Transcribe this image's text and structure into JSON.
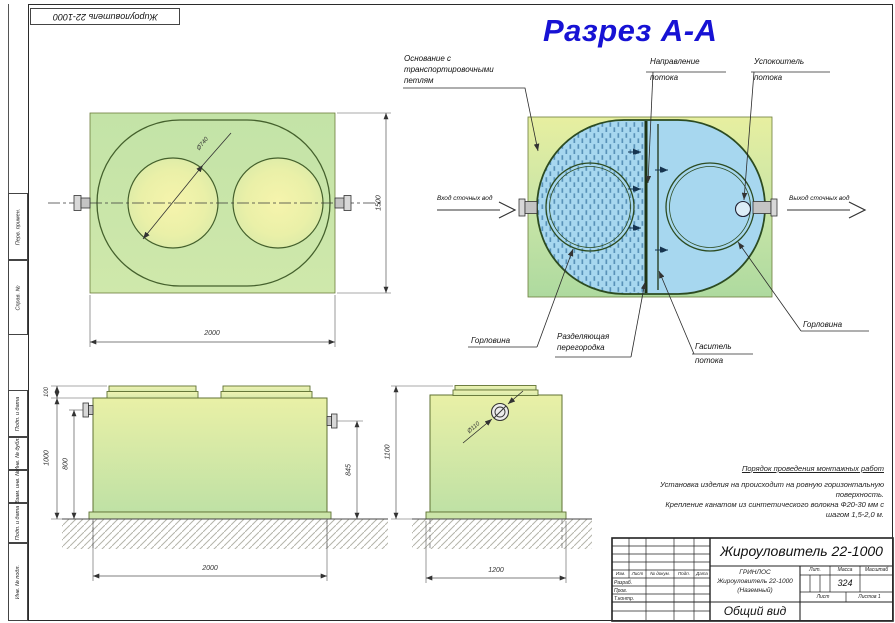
{
  "drawing": {
    "corner_stamp": "Жироуловитель 22-1000",
    "margin_labels": [
      "Перв. примен.",
      "Справ. №",
      "Подп. и дата",
      "Инв. № дубл.",
      "Взам. инв. №",
      "Подп. и дата",
      "Инв. № подл."
    ]
  },
  "colors": {
    "section_title_blue": "#1712d4",
    "tank_green": "#cde7ab",
    "water_blue": "#a7d7ef"
  },
  "section": {
    "title": "Разрез А-А",
    "callouts": {
      "base": [
        "Основание с",
        "транспортировочными",
        "петлям"
      ],
      "flow_direction": [
        "Направление",
        "потока"
      ],
      "flow_calmer": [
        "Успокоитель",
        "потока"
      ],
      "inlet": "Вход сточных вод",
      "outlet": "Выход сточных вод",
      "neck_left": "Горловина",
      "divider": [
        "Разделяющая",
        "перегородка"
      ],
      "damper": [
        "Гаситель",
        "потока"
      ],
      "neck_right": "Горловина"
    }
  },
  "plan": {
    "dim_length": "2000",
    "dim_width": "1500",
    "dim_neck": "Ø740"
  },
  "front": {
    "dim_lid": "100",
    "dim_height": "1000",
    "dim_inlet": "800",
    "dim_outlet": "845",
    "dim_length": "2000"
  },
  "side": {
    "dim_height": "1100",
    "dim_base": "1200",
    "dim_pipe": "Ø110"
  },
  "notes": {
    "heading": "Порядок проведения монтажных работ",
    "lines": [
      "Установка изделия на происходит на ровную горизонтальную",
      "поверхность.",
      "Крепление канатом из синтетического волокна Ф20-30 мм с",
      "шагом 1,5-2,0 м."
    ]
  },
  "title_block": {
    "doc_name": "Жироуловитель 22-1000",
    "org": "ГРИНЛОС",
    "product": "Жироуловитель 22-1000",
    "variant": "(Наземный)",
    "view": "Общий вид",
    "lit": "Лит.",
    "mass": "Масса",
    "scale": "Масштаб",
    "mass_value": "324",
    "sheet": "Лист",
    "sheets": "Листов 1",
    "cols": [
      "Изм.",
      "Лист",
      "№ докум.",
      "Подп.",
      "Дата"
    ],
    "rows": [
      "Разраб.",
      "Пров.",
      "Т.контр."
    ]
  }
}
